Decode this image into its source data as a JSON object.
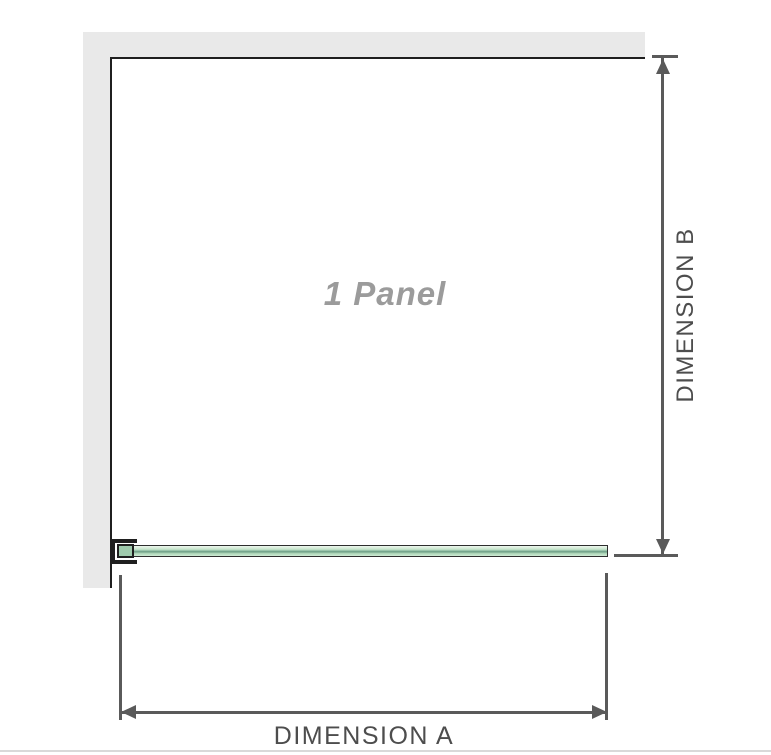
{
  "diagram": {
    "title": "1 Panel shower screen plan diagram",
    "panel_label": "1 Panel",
    "dimension_a_label": "DIMENSION A",
    "dimension_b_label": "DIMENSION B",
    "colors": {
      "wall_fill": "#e9e9e9",
      "wall_edge": "#1f1f1f",
      "dimension_line": "#5a5a5a",
      "dimension_text": "#4d4d4d",
      "panel_label_color": "#9b9b9b",
      "glass_green_light": "#d5ecd8",
      "glass_green_dark": "#6f9f87",
      "glass_border": "#2e2e2e",
      "footer_line": "#d9d9d9"
    }
  }
}
